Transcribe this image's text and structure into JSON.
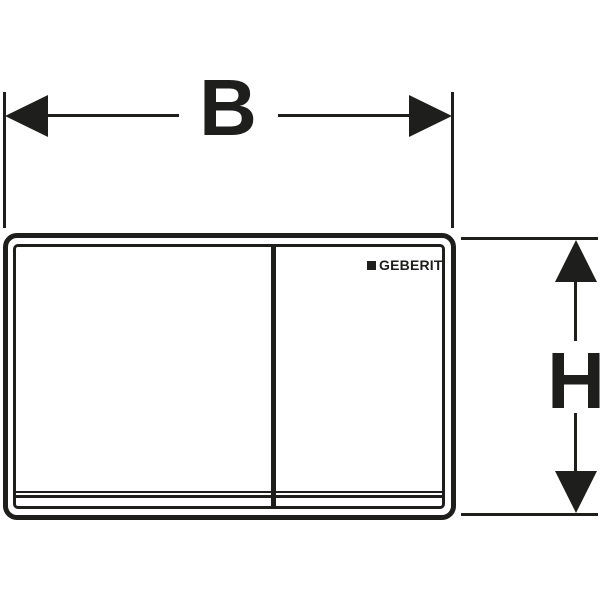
{
  "colors": {
    "ink": "#1e1e1c",
    "bg": "#ffffff"
  },
  "diagram": {
    "type": "technical-dimension-drawing",
    "width_dimension": {
      "label": "B"
    },
    "height_dimension": {
      "label": "H"
    },
    "plate": {
      "brand_logo_text": "GEBERIT"
    }
  }
}
